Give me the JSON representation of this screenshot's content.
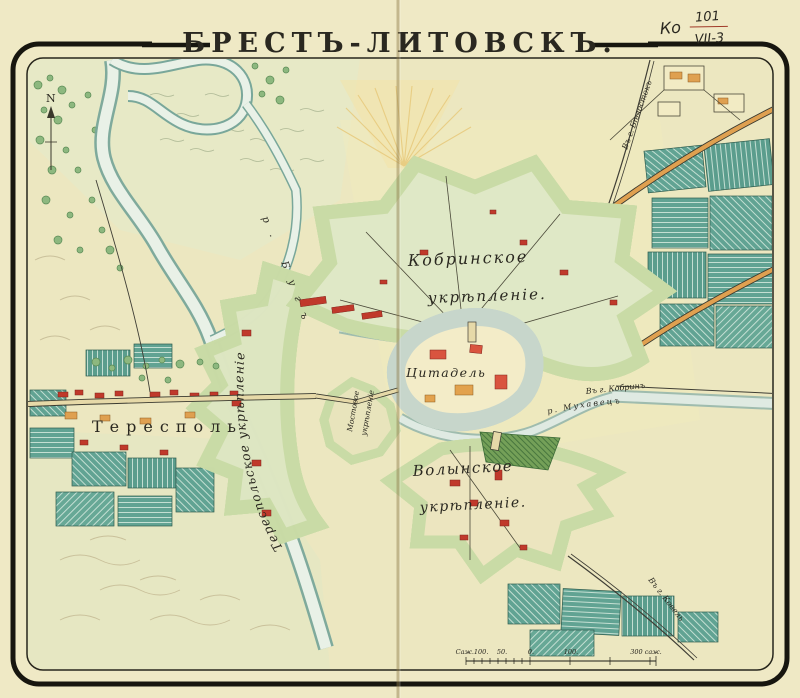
{
  "title": "БРЕСТЪ-ЛИТОВСКЪ.",
  "archive_mark": {
    "prefix": "Ко",
    "numerator": "101",
    "denominator": "VII-3"
  },
  "compass_n": "N",
  "map_labels": {
    "kobrin_1": "Кобринское",
    "kobrin_2": "укрѣпленіе.",
    "citadel": "Цитадель",
    "volyn_1": "Волынское",
    "volyn_2": "укрѣпленіе.",
    "terespol_fort": "Тереспольское укрѣпленіе",
    "mostovoe_1": "Мостовое",
    "mostovoe_2": "укрѣпленіе",
    "terespol_town": "Тересполь",
    "river_bug": "р. Бугъ",
    "river_mukhavets": "р. Мухавецъ",
    "road_bialystok": "Въ г. Бѣлостокъ",
    "road_kobrin": "Въ г. Кобринъ",
    "road_kovel": "Въ г. Ковель"
  },
  "scale_bar": {
    "label_start": "Саж.100.",
    "label_50": "50.",
    "label_0": "0.",
    "label_100": "100.",
    "label_300": "300 саж."
  },
  "colors": {
    "paper": "#efe9c5",
    "frame_ink": "#17160f",
    "field_teal": "#61a393",
    "fort_interior_green": "#dfe8c6",
    "rampart_brown": "#7a4a33",
    "rampart_dark_green": "#2f4f3a",
    "glacis_green": "#c9dba6",
    "citadel_red": "#cf4f44",
    "building_red": "#c0392b",
    "building_orange": "#dfa050",
    "water_light": "#e9f1e7",
    "water_edge": "#79a79a",
    "red_ink": "#a03a28"
  }
}
